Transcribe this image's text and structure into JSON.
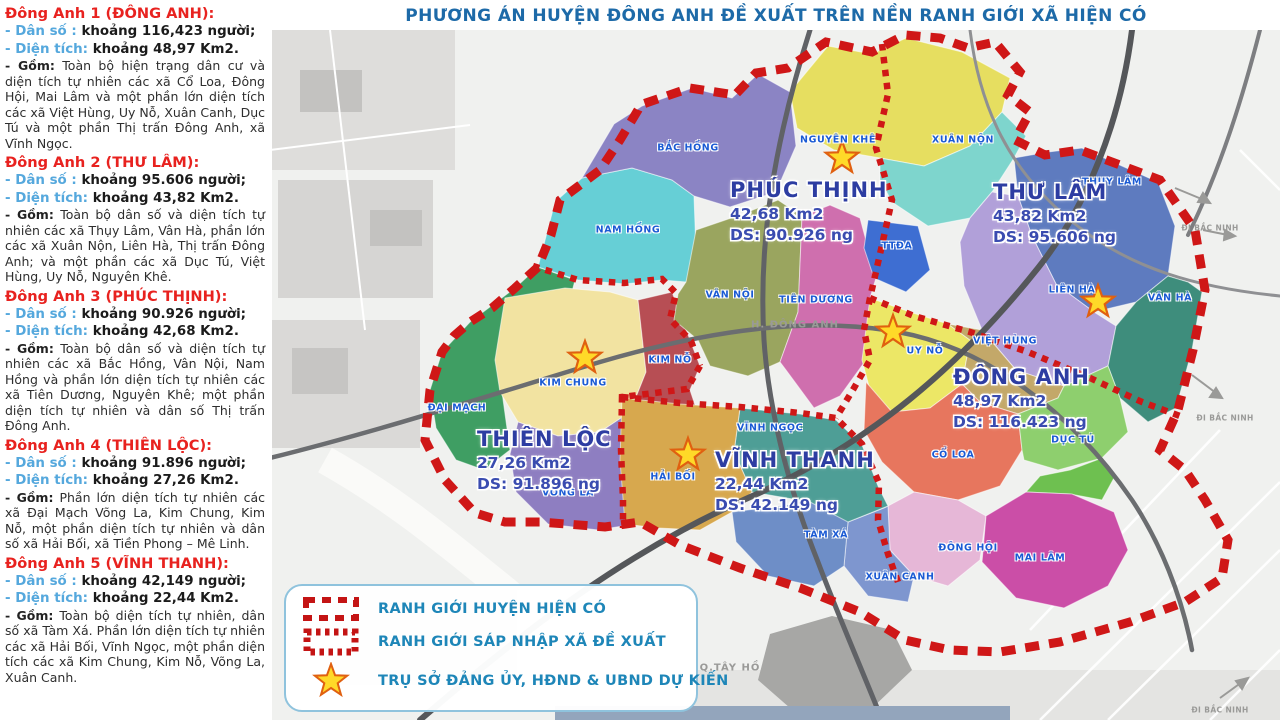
{
  "title": "PHƯƠNG ÁN HUYỆN ĐÔNG ANH ĐỀ XUẤT TRÊN NỀN RANH GIỚI XÃ HIỆN CÓ",
  "sidebar": {
    "sections": [
      {
        "heading": "Đông Anh 1 (ĐÔNG ANH):",
        "pop_label": "- Dân số :",
        "pop_value": "khoảng 116,423 người;",
        "area_label": "- Diện tích:",
        "area_value": "khoảng 48,97 Km2.",
        "gom_label": "- Gồm:",
        "gom_text": "Toàn bộ hiện trạng dân cư và diện tích tự nhiên các xã Cổ Loa, Đông Hội, Mai Lâm và một phần lớn diện tích các xã Việt Hùng, Uy Nỗ, Xuân Canh, Dục Tú và một phần Thị trấn Đông Anh, xã Vĩnh Ngọc."
      },
      {
        "heading": "Đông Anh 2 (THƯ LÂM):",
        "pop_label": "- Dân số :",
        "pop_value": "khoảng 95.606 người;",
        "area_label": "- Diện tích:",
        "area_value": "khoảng 43,82 Km2.",
        "gom_label": "- Gồm:",
        "gom_text": "Toàn bộ dân số và diện tích tự nhiên các xã Thụy Lâm, Vân Hà, phần lớn các xã Xuân Nộn, Liên Hà, Thị trấn Đông Anh; và một phần các xã Dục Tú, Việt Hùng, Uy Nỗ, Nguyên Khê."
      },
      {
        "heading": "Đông Anh 3 (PHÚC THỊNH):",
        "pop_label": "- Dân số :",
        "pop_value": "khoảng 90.926 người;",
        "area_label": "- Diện tích:",
        "area_value": "khoảng 42,68 Km2.",
        "gom_label": "- Gồm:",
        "gom_text": "Toàn bộ dân số và diện tích tự nhiên các xã Bắc Hồng, Vân Nội, Nam Hồng và phần lớn diện tích tự nhiên các xã Tiên Dương, Nguyên Khê; một phần diện tích tự nhiên và dân số Thị trấn Đông Anh."
      },
      {
        "heading": "Đông Anh 4 (THIÊN LỘC):",
        "pop_label": "- Dân số :",
        "pop_value": "khoảng 91.896 người;",
        "area_label": "- Diện tích:",
        "area_value": "khoảng 27,26 Km2.",
        "gom_label": "- Gồm:",
        "gom_text": "Phần lớn diện tích tự nhiên các xã Đại Mạch Võng La, Kim Chung, Kim Nỗ, một phần diện tích tự nhiên và dân số xã Hải Bối, xã Tiền Phong – Mê Linh."
      },
      {
        "heading": "Đông Anh 5 (VĨNH THANH):",
        "pop_label": "- Dân số :",
        "pop_value": "khoảng 42,149 người;",
        "area_label": "- Diện tích:",
        "area_value": "khoảng 22,44 Km2.",
        "gom_label": "- Gồm:",
        "gom_text": "Toàn bộ diện tích tự nhiên, dân số xã Tàm Xá. Phần lớn diện tích tự nhiên các xã Hải Bối, Vĩnh Ngọc, một phần diện tích các xã Kim Chung, Kim Nỗ, Võng La, Xuân Canh."
      }
    ]
  },
  "map": {
    "communes": [
      {
        "name": "PHÚC THỊNH",
        "area": "42,68 Km2",
        "ds": "DS: 90.926 ng"
      },
      {
        "name": "THƯ LÂM",
        "area": "43,82 Km2",
        "ds": "DS: 95.606 ng"
      },
      {
        "name": "ĐÔNG ANH",
        "area": "48,97 Km2",
        "ds": "DS: 116.423 ng"
      },
      {
        "name": "THIÊN LỘC",
        "area": "27,26 Km2",
        "ds": "DS: 91.896 ng"
      },
      {
        "name": "VĨNH THANH",
        "area": "22,44 Km2",
        "ds": "DS: 42.149 ng"
      }
    ],
    "wards": [
      "BẮC HỒNG",
      "NGUYÊN KHÊ",
      "XUÂN NỘN",
      "THỤY LÂM",
      "NAM HỒNG",
      "TTĐA",
      "VÂN NỘI",
      "TIÊN DƯƠNG",
      "LIÊN HÀ",
      "VÂN HÀ",
      "UY NỖ",
      "VIỆT HÙNG",
      "KIM NỖ",
      "KIM CHUNG",
      "ĐẠI MẠCH",
      "VÕNG LA",
      "HẢI BỐI",
      "VĨNH NGỌC",
      "CỔ LOA",
      "DỤC TÚ",
      "TÀM XÁ",
      "XUÂN CANH",
      "ĐÔNG HỘI",
      "MAI LÂM"
    ],
    "context": {
      "district_label": "H. ĐÔNG ANH",
      "tay_ho": "Q.TÂY HỒ",
      "di_bac_ninh": "ĐI BẮC NINH"
    },
    "colors": {
      "boundary_red": "#cf1717",
      "star_fill": "#ffd928",
      "star_stroke": "#e06010",
      "title_blue": "#1d6aa8",
      "legend_blue": "#1e86b8",
      "heading_red": "#e8221f",
      "stat_label_blue": "#55a8dd"
    }
  },
  "legend": {
    "items": [
      {
        "label": "RANH GIỚI HUYỆN HIỆN CÓ"
      },
      {
        "label": "RANH GIỚI SÁP NHẬP XÃ ĐỀ XUẤT"
      },
      {
        "label": "TRỤ SỞ ĐẢNG ỦY, HĐND & UBND DỰ KIẾN"
      }
    ]
  }
}
